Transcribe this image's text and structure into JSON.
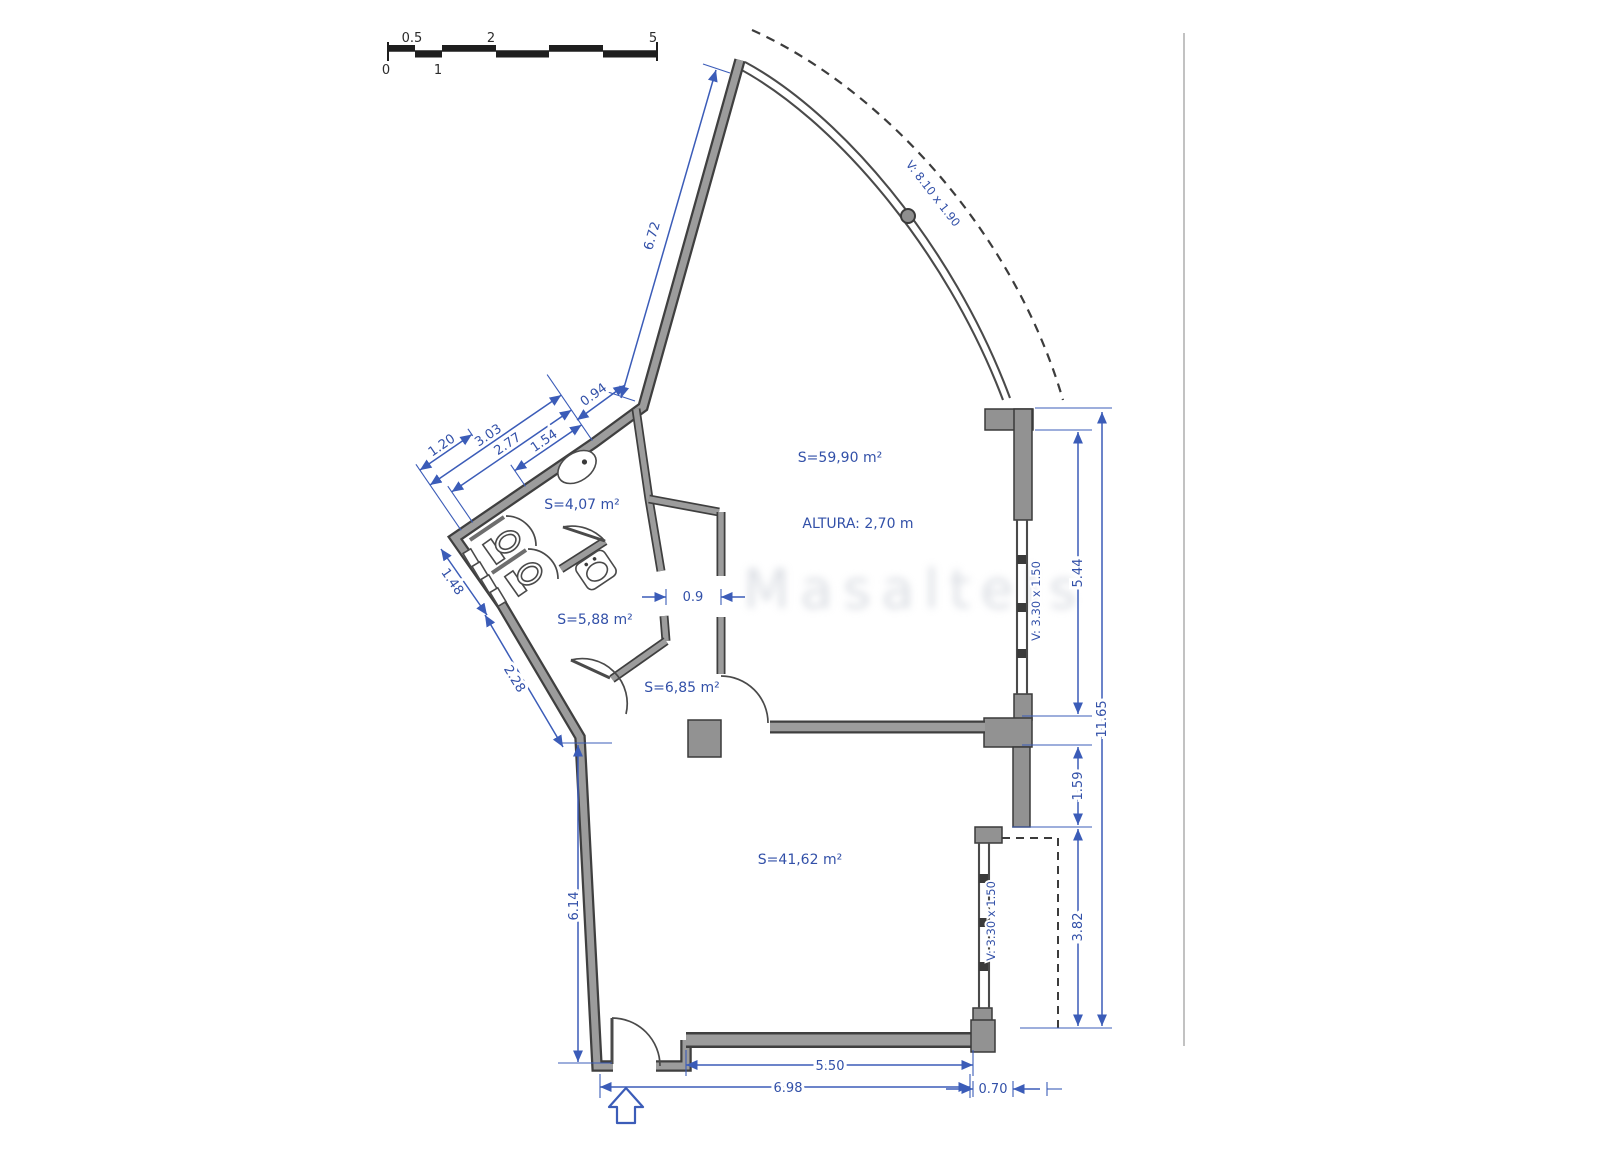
{
  "scale_bar": {
    "n0": "0",
    "n05": "0.5",
    "n1": "1",
    "n2": "2",
    "n5": "5"
  },
  "rooms": {
    "main_area": "S=59,90 m²",
    "height": "ALTURA: 2,70 m",
    "wc": "S=4,07 m²",
    "bath": "S=5,88 m²",
    "hall": "S=6,85 m²",
    "lower_area": "S=41,62 m²"
  },
  "windows": {
    "curved": "V: 8.10 x 1.90",
    "right_upper": "V: 3.30 x 1.50",
    "right_lower": "V: 3.30 x 1.50"
  },
  "dimensions": {
    "diag_wall": "6.72",
    "jog": "0.94",
    "bath_303": "3.03",
    "bath_277": "2.77",
    "bath_154": "1.54",
    "bath_120": "1.20",
    "left_148": "1.48",
    "left_228": "2.28",
    "left_height": "6.14",
    "bottom_inner": "5.50",
    "bottom_outer": "6.98",
    "bottom_right": "0.70",
    "hall_door": "0.9",
    "right_upper": "5.44",
    "right_mid": "1.59",
    "right_lower": "3.82",
    "right_total": "11.65"
  },
  "watermark": {
    "text": "Masaltels"
  },
  "colors": {
    "dimension_blue": "#3b5cb8",
    "wall_gray": "#9c9c9c",
    "wall_edge": "#3f3f3f"
  }
}
